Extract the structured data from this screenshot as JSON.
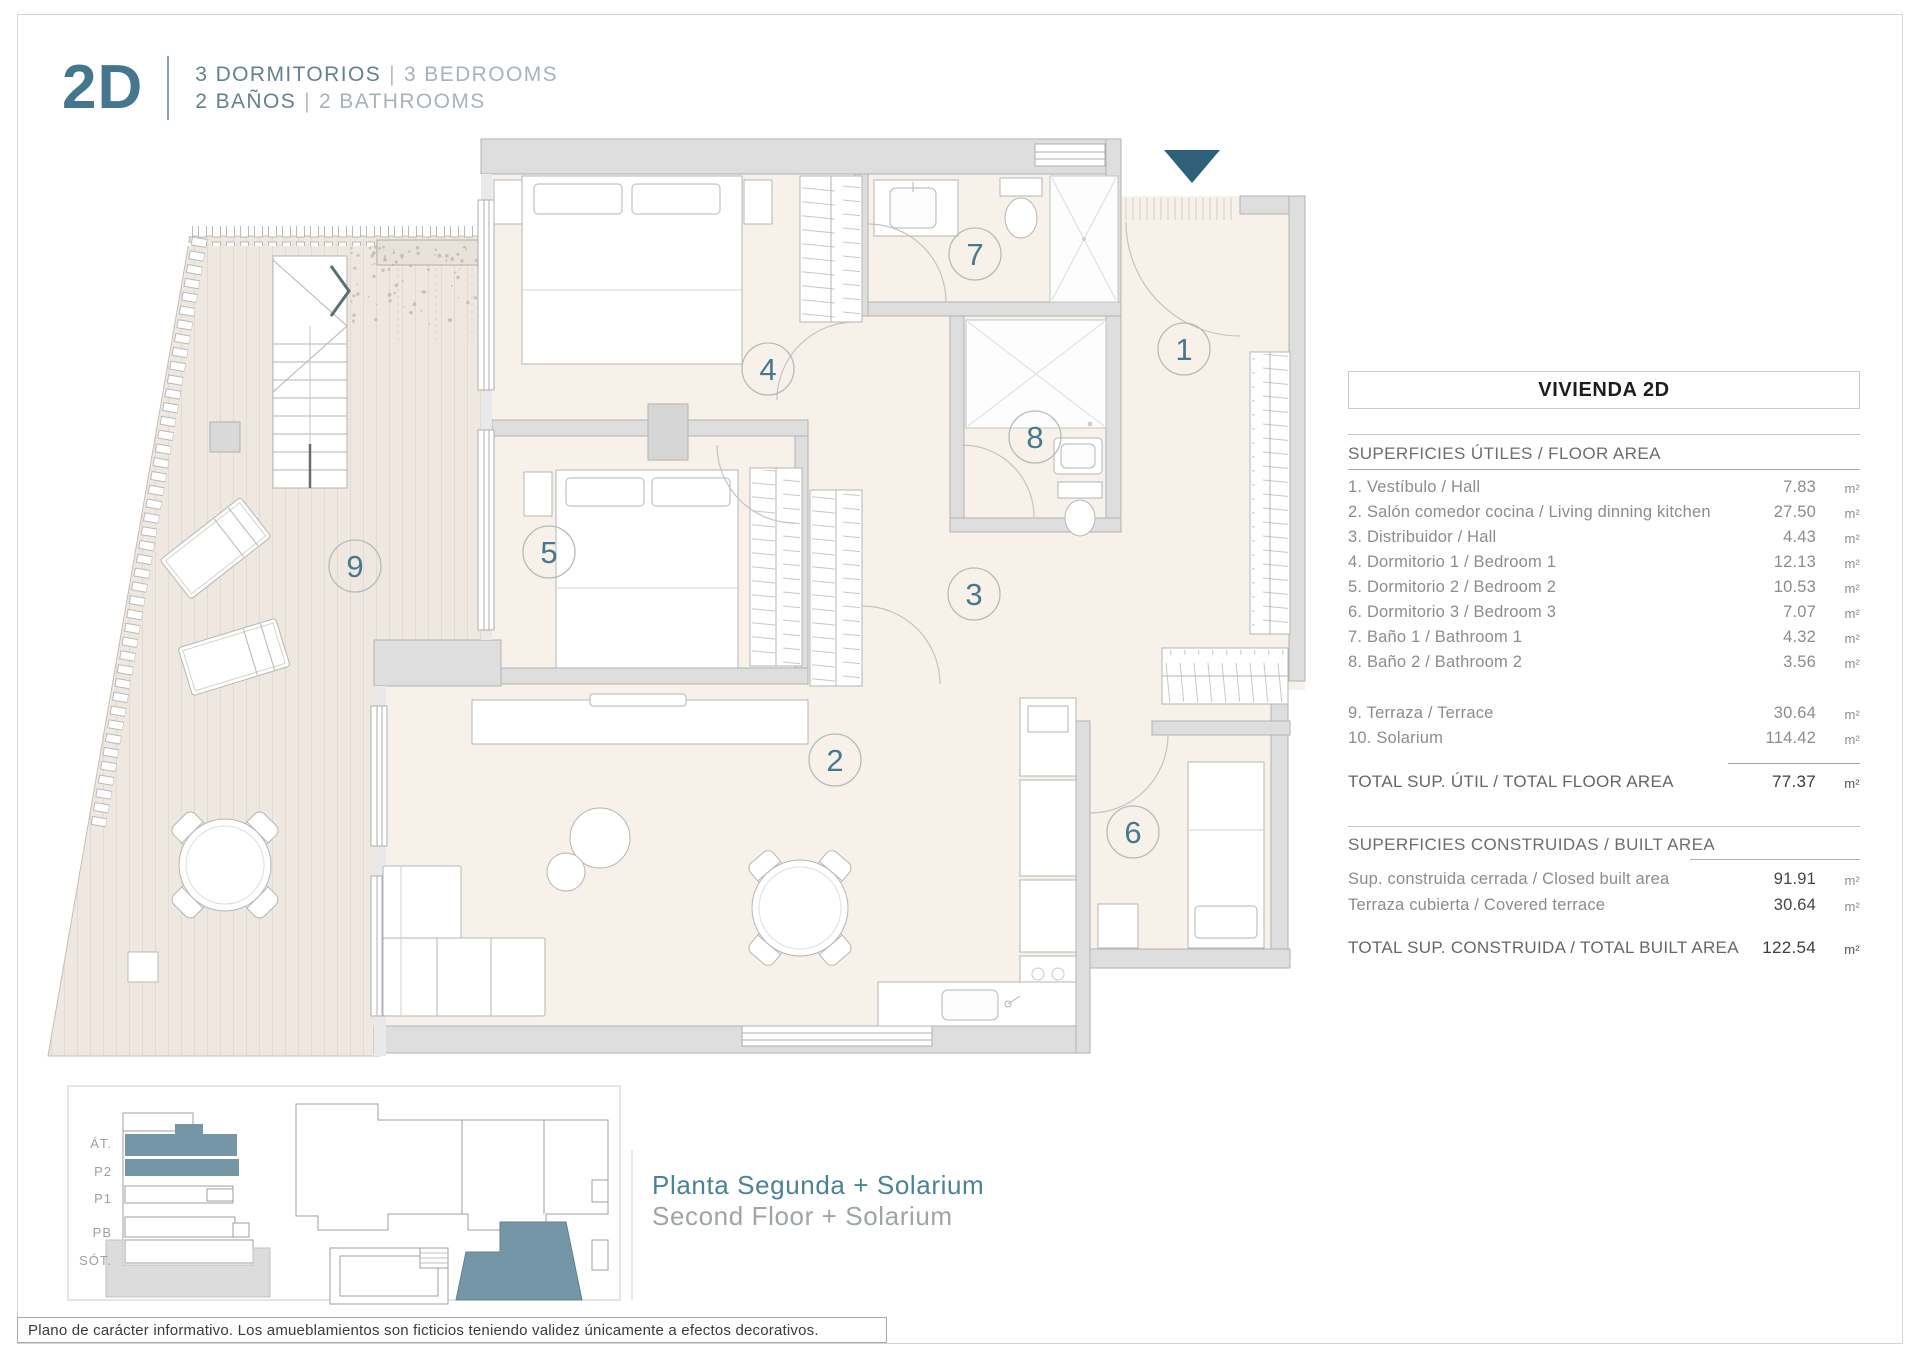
{
  "header": {
    "unit": "2D",
    "line1_es": "3 DORMITORIOS",
    "line1_en": "3 BEDROOMS",
    "line2_es": "2 BAÑOS",
    "line2_en": "2 BATHROOMS",
    "separator": "|"
  },
  "panel": {
    "title": "VIVIENDA 2D",
    "floor_area": {
      "header": "SUPERFICIES ÚTILES / FLOOR AREA",
      "rows": [
        {
          "label": "1. Vestíbulo / Hall",
          "value": "7.83",
          "unit": "m²"
        },
        {
          "label": "2. Salón comedor cocina / Living dinning kitchen",
          "value": "27.50",
          "unit": "m²"
        },
        {
          "label": "3. Distribuidor / Hall",
          "value": "4.43",
          "unit": "m²"
        },
        {
          "label": "4. Dormitorio 1 / Bedroom 1",
          "value": "12.13",
          "unit": "m²"
        },
        {
          "label": "5. Dormitorio 2 / Bedroom 2",
          "value": "10.53",
          "unit": "m²"
        },
        {
          "label": "6. Dormitorio 3 / Bedroom 3",
          "value": "7.07",
          "unit": "m²"
        },
        {
          "label": "7. Baño 1 / Bathroom 1",
          "value": "4.32",
          "unit": "m²"
        },
        {
          "label": "8. Baño 2 / Bathroom 2",
          "value": "3.56",
          "unit": "m²"
        }
      ],
      "extra_rows": [
        {
          "label": "9. Terraza / Terrace",
          "value": "30.64",
          "unit": "m²"
        },
        {
          "label": "10. Solarium",
          "value": "114.42",
          "unit": "m²"
        }
      ],
      "total": {
        "label": "TOTAL SUP. ÚTIL / TOTAL FLOOR AREA",
        "value": "77.37",
        "unit": "m²"
      }
    },
    "built_area": {
      "header": "SUPERFICIES CONSTRUIDAS / BUILT AREA",
      "rows": [
        {
          "label": "Sup. construida cerrada / Closed built area",
          "value": "91.91",
          "unit": "m²"
        },
        {
          "label": "Terraza cubierta / Covered terrace",
          "value": "30.64",
          "unit": "m²"
        }
      ],
      "total": {
        "label": "TOTAL SUP. CONSTRUIDA /  TOTAL BUILT AREA",
        "value": "122.54",
        "unit": "m²"
      }
    }
  },
  "plan": {
    "room_numbers": [
      "1",
      "2",
      "3",
      "4",
      "5",
      "6",
      "7",
      "8",
      "9"
    ]
  },
  "legend": {
    "floors": [
      "ÁT.",
      "P2",
      "P1",
      "PB",
      "SÓT."
    ],
    "title_es": "Planta Segunda + Solarium",
    "title_en": "Second Floor + Solarium"
  },
  "footer": {
    "disclaimer": "Plano de carácter informativo. Los amueblamientos son ficticios teniendo validez únicamente a efectos decorativos."
  },
  "colors": {
    "teal": "#44768d",
    "teal_dark": "#2e607a",
    "unit_highlight": "#7496a6",
    "floor_beige": "#f7f1ea",
    "wall_gray": "#dedede"
  }
}
